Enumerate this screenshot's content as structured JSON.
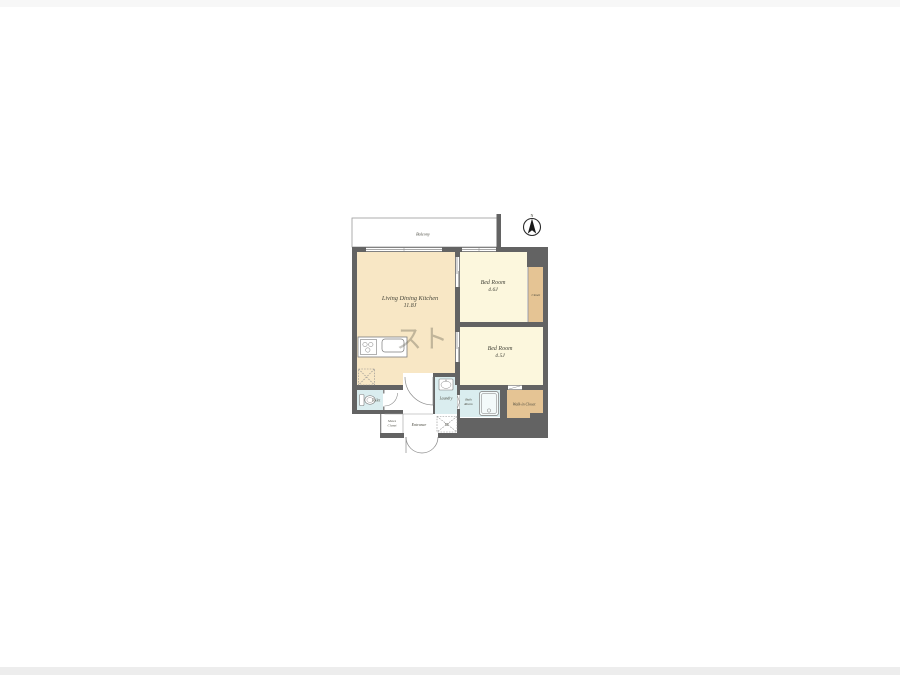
{
  "page": {
    "background": "#ffffff"
  },
  "compass": {
    "label": "N"
  },
  "watermark": {
    "text": "スト"
  },
  "balcony": {
    "label": "Balcony"
  },
  "rooms": {
    "ldk": {
      "name": "Living Dining Kitchen",
      "area": "11.8J"
    },
    "bedroom1": {
      "name": "Bed Room",
      "area": "4.6J"
    },
    "bedroom2": {
      "name": "Bed Room",
      "area": "4.5J"
    },
    "closet": {
      "name": "Closet"
    },
    "walk_in_closet": {
      "name": "Walk-in Closet"
    },
    "toilet": {
      "name": "Toilet"
    },
    "laundry": {
      "name": "Laundry"
    },
    "bath": {
      "name_line1": "Bath",
      "name_line2": "Room"
    },
    "shoes_closet": {
      "name_line1": "Shoes",
      "name_line2": "Closet"
    },
    "entrance": {
      "name": "Entrance"
    },
    "washer": {
      "label": "W"
    }
  },
  "colors": {
    "wall": "#636363",
    "ldk": "#f8e7c5",
    "bedroom": "#fcf7dd",
    "closet": "#e5c494",
    "wet": "#daedef",
    "white": "#ffffff",
    "thin_line": "#8a8a8a"
  }
}
